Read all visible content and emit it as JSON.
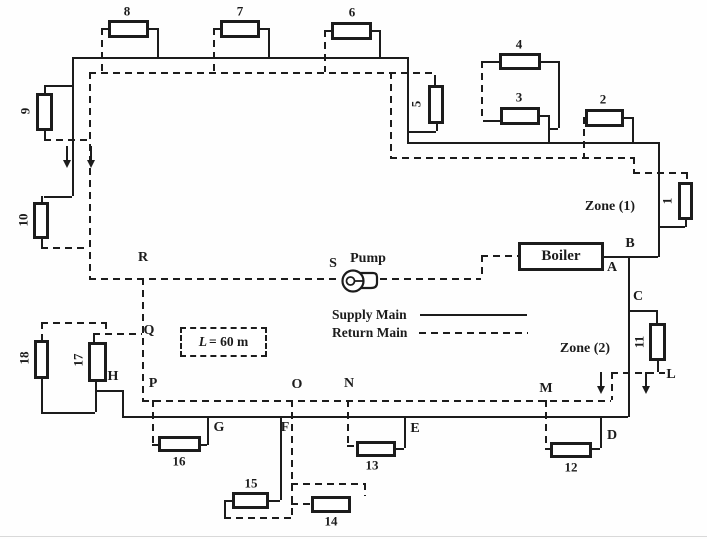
{
  "diagram": {
    "boiler_label": "Boiler",
    "pump_label": "Pump",
    "zone1_label": "Zone (1)",
    "zone2_label": "Zone (2)",
    "length_note": {
      "symbol": "L",
      "value": "= 60 m"
    },
    "legend": {
      "supply_label": "Supply Main",
      "return_label": "Return Main"
    },
    "colors": {
      "ink": "#1c1c1c",
      "paper": "#fefefe"
    },
    "junction_labels": [
      {
        "id": "A",
        "x": 612,
        "y": 268
      },
      {
        "id": "B",
        "x": 630,
        "y": 244
      },
      {
        "id": "C",
        "x": 638,
        "y": 297
      },
      {
        "id": "D",
        "x": 612,
        "y": 436
      },
      {
        "id": "E",
        "x": 415,
        "y": 429
      },
      {
        "id": "F",
        "x": 285,
        "y": 428
      },
      {
        "id": "G",
        "x": 219,
        "y": 428
      },
      {
        "id": "H",
        "x": 113,
        "y": 377
      },
      {
        "id": "L",
        "x": 671,
        "y": 375
      },
      {
        "id": "M",
        "x": 546,
        "y": 389
      },
      {
        "id": "N",
        "x": 349,
        "y": 384
      },
      {
        "id": "O",
        "x": 297,
        "y": 385
      },
      {
        "id": "P",
        "x": 153,
        "y": 384
      },
      {
        "id": "Q",
        "x": 149,
        "y": 331
      },
      {
        "id": "R",
        "x": 143,
        "y": 258
      },
      {
        "id": "S",
        "x": 333,
        "y": 264
      }
    ],
    "radiators": [
      {
        "n": "1",
        "x": 678,
        "y": 182,
        "w": 15,
        "h": 38,
        "lx": 667,
        "ly": 201,
        "rot": true
      },
      {
        "n": "2",
        "x": 585,
        "y": 109,
        "w": 39,
        "h": 18,
        "lx": 603,
        "ly": 99,
        "rot": false
      },
      {
        "n": "3",
        "x": 500,
        "y": 107,
        "w": 40,
        "h": 18,
        "lx": 519,
        "ly": 97,
        "rot": false
      },
      {
        "n": "4",
        "x": 499,
        "y": 53,
        "w": 42,
        "h": 17,
        "lx": 519,
        "ly": 44,
        "rot": false
      },
      {
        "n": "5",
        "x": 428,
        "y": 85,
        "w": 16,
        "h": 39,
        "lx": 416,
        "ly": 104,
        "rot": true
      },
      {
        "n": "6",
        "x": 331,
        "y": 22,
        "w": 41,
        "h": 18,
        "lx": 352,
        "ly": 12,
        "rot": false
      },
      {
        "n": "7",
        "x": 220,
        "y": 20,
        "w": 40,
        "h": 18,
        "lx": 240,
        "ly": 11,
        "rot": false
      },
      {
        "n": "8",
        "x": 108,
        "y": 20,
        "w": 41,
        "h": 18,
        "lx": 127,
        "ly": 11,
        "rot": false
      },
      {
        "n": "9",
        "x": 36,
        "y": 93,
        "w": 17,
        "h": 38,
        "lx": 25,
        "ly": 111,
        "rot": true
      },
      {
        "n": "10",
        "x": 33,
        "y": 202,
        "w": 16,
        "h": 37,
        "lx": 23,
        "ly": 220,
        "rot": true
      },
      {
        "n": "11",
        "x": 649,
        "y": 323,
        "w": 17,
        "h": 38,
        "lx": 639,
        "ly": 342,
        "rot": true
      },
      {
        "n": "12",
        "x": 550,
        "y": 442,
        "w": 42,
        "h": 16,
        "lx": 571,
        "ly": 467,
        "rot": false
      },
      {
        "n": "13",
        "x": 356,
        "y": 441,
        "w": 40,
        "h": 16,
        "lx": 372,
        "ly": 465,
        "rot": false
      },
      {
        "n": "14",
        "x": 311,
        "y": 496,
        "w": 40,
        "h": 17,
        "lx": 331,
        "ly": 521,
        "rot": false
      },
      {
        "n": "15",
        "x": 232,
        "y": 492,
        "w": 37,
        "h": 17,
        "lx": 251,
        "ly": 483,
        "rot": false
      },
      {
        "n": "16",
        "x": 158,
        "y": 436,
        "w": 43,
        "h": 16,
        "lx": 179,
        "ly": 461,
        "rot": false
      },
      {
        "n": "17",
        "x": 88,
        "y": 342,
        "w": 19,
        "h": 40,
        "lx": 78,
        "ly": 360,
        "rot": true
      },
      {
        "n": "18",
        "x": 34,
        "y": 340,
        "w": 15,
        "h": 39,
        "lx": 24,
        "ly": 358,
        "rot": true
      }
    ],
    "flow_arrows": [
      {
        "x": 66,
        "y": 146
      },
      {
        "x": 90,
        "y": 146
      },
      {
        "x": 600,
        "y": 372
      },
      {
        "x": 645,
        "y": 372
      }
    ],
    "geometry": {
      "solid_h": [
        [
          72,
          57,
          335
        ],
        [
          407,
          142,
          251
        ],
        [
          603,
          256,
          55
        ],
        [
          122,
          416,
          506
        ],
        [
          44,
          85,
          28
        ],
        [
          44,
          196,
          28
        ],
        [
          149,
          28,
          8
        ],
        [
          260,
          28,
          8
        ],
        [
          372,
          30,
          7
        ],
        [
          407,
          131,
          29
        ],
        [
          483,
          61,
          17
        ],
        [
          541,
          61,
          17
        ],
        [
          540,
          115,
          8
        ],
        [
          548,
          128,
          10
        ],
        [
          624,
          117,
          8
        ],
        [
          658,
          226,
          27
        ],
        [
          628,
          310,
          28
        ],
        [
          592,
          448,
          8
        ],
        [
          396,
          448,
          8
        ],
        [
          269,
          500,
          11
        ],
        [
          224,
          500,
          8
        ],
        [
          201,
          444,
          6
        ],
        [
          95,
          390,
          27
        ],
        [
          41,
          412,
          54
        ],
        [
          483,
          120,
          17
        ],
        [
          420,
          314,
          107
        ]
      ],
      "solid_v": [
        [
          72,
          57,
          139
        ],
        [
          44,
          85,
          9
        ],
        [
          44,
          131,
          8
        ],
        [
          41,
          196,
          7
        ],
        [
          41,
          239,
          8
        ],
        [
          157,
          28,
          30
        ],
        [
          268,
          28,
          30
        ],
        [
          379,
          30,
          28
        ],
        [
          407,
          57,
          86
        ],
        [
          434,
          75,
          10
        ],
        [
          436,
          124,
          7
        ],
        [
          558,
          61,
          67
        ],
        [
          548,
          115,
          28
        ],
        [
          632,
          117,
          26
        ],
        [
          658,
          142,
          115
        ],
        [
          685,
          220,
          7
        ],
        [
          628,
          256,
          161
        ],
        [
          656,
          310,
          13
        ],
        [
          657,
          361,
          11
        ],
        [
          600,
          416,
          32
        ],
        [
          404,
          416,
          32
        ],
        [
          280,
          416,
          84
        ],
        [
          207,
          416,
          29
        ],
        [
          122,
          390,
          27
        ],
        [
          95,
          382,
          30
        ],
        [
          41,
          379,
          33
        ],
        [
          93,
          333,
          9
        ],
        [
          224,
          500,
          17
        ]
      ],
      "dash_h": [
        [
          89,
          72,
          344
        ],
        [
          44,
          139,
          45
        ],
        [
          41,
          247,
          48
        ],
        [
          101,
          28,
          7
        ],
        [
          213,
          28,
          7
        ],
        [
          324,
          30,
          7
        ],
        [
          390,
          157,
          243
        ],
        [
          633,
          172,
          53
        ],
        [
          89,
          278,
          252
        ],
        [
          380,
          278,
          101
        ],
        [
          481,
          255,
          37
        ],
        [
          93,
          333,
          49
        ],
        [
          41,
          322,
          64
        ],
        [
          142,
          400,
          469
        ],
        [
          611,
          372,
          54
        ],
        [
          152,
          444,
          6
        ],
        [
          347,
          445,
          9
        ],
        [
          545,
          448,
          5
        ],
        [
          224,
          517,
          67
        ],
        [
          291,
          483,
          73
        ],
        [
          291,
          503,
          20
        ],
        [
          419,
          332,
          109
        ]
      ],
      "dash_v": [
        [
          89,
          72,
          206
        ],
        [
          101,
          28,
          44
        ],
        [
          213,
          28,
          44
        ],
        [
          324,
          30,
          42
        ],
        [
          390,
          72,
          85
        ],
        [
          481,
          61,
          59
        ],
        [
          583,
          117,
          40
        ],
        [
          633,
          157,
          15
        ],
        [
          686,
          172,
          10
        ],
        [
          481,
          255,
          23
        ],
        [
          142,
          278,
          122
        ],
        [
          105,
          322,
          11
        ],
        [
          611,
          372,
          28
        ],
        [
          545,
          400,
          48
        ],
        [
          347,
          400,
          45
        ],
        [
          291,
          400,
          117
        ],
        [
          364,
          483,
          13
        ],
        [
          152,
          400,
          44
        ],
        [
          41,
          322,
          18
        ]
      ]
    }
  }
}
